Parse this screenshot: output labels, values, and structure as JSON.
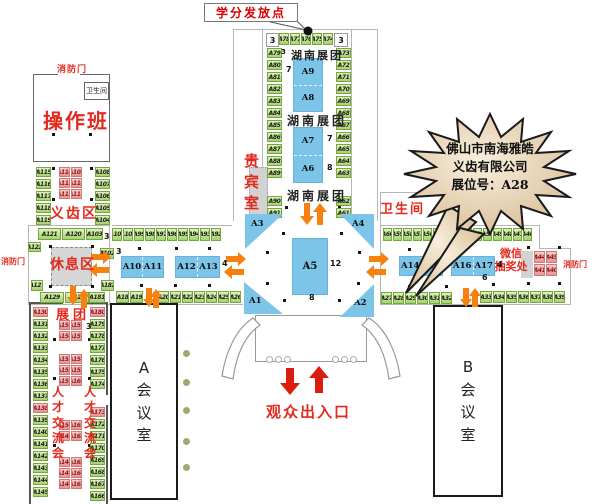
{
  "callout": {
    "label": "学分发放点"
  },
  "labels": {
    "fire_door": "消防门",
    "restroom_small": "卫生间",
    "operation_room": "操作班",
    "denture_zone": "义齿区",
    "vip_room": "贵\n宾\n室",
    "rest_area": "休息区",
    "hunan_pavilion": "湖南展团",
    "restroom_right": "卫生间",
    "wechat_lottery": "微信\n抽奖处",
    "exhibit_group": "展团",
    "talent_fair": "人\n才\n交\n流\n会",
    "hall_a": "A\n会\n议\n室",
    "hall_b": "B\n会\n议\n室",
    "entrance": "观众出入口"
  },
  "star": {
    "line1": "佛山市南海雅皓",
    "line2": "义齿有限公司",
    "line3": "展位号：A28"
  },
  "numbers": {
    "top_left": "3",
    "top_right": "3",
    "hunan_3": "3",
    "n7_a9": "7",
    "n7_a7": "7",
    "n8_a6": "8",
    "n12_a5": "12",
    "n8_a5": "8",
    "n4_a13": "4",
    "n4_a17": "4",
    "n6_a17": "6",
    "n3_a103": "3",
    "n3_a102": "3",
    "n3_talent": "3"
  },
  "blue": {
    "a1": "A1",
    "a2": "A2",
    "a3": "A3",
    "a4": "A4",
    "a5": "A5",
    "a6": "A6",
    "a7": "A7",
    "a8": "A8",
    "a9": "A9",
    "a10": "A10",
    "a11": "A11",
    "a12": "A12",
    "a13": "A13",
    "a14": "A14",
    "a15": "A15",
    "a16": "A16",
    "a17": "A17"
  },
  "booths": {
    "tower_top_row": [
      "A78",
      "A77",
      "A76",
      "A75",
      "A74"
    ],
    "tower_left_col": [
      "A79",
      "A80",
      "A81",
      "A82",
      "A83",
      "A84",
      "A85",
      "A86",
      "A87",
      "A88",
      "A89"
    ],
    "tower_left_lower": [
      "A90",
      "A91"
    ],
    "tower_right_col": [
      "A73",
      "A72",
      "A71",
      "A70",
      "A69",
      "A68",
      "A67",
      "A66",
      "A65",
      "A64",
      "A63"
    ],
    "tower_right_lower": [
      "A62",
      "A61"
    ],
    "dental_left": [
      "A115",
      "A116",
      "A117",
      "A118",
      "A119"
    ],
    "dental_pink": [
      "A114",
      "A109",
      "A113",
      "A110",
      "A112",
      "A111"
    ],
    "dental_right": [
      "A108",
      "A107",
      "A106",
      "A105",
      "A104"
    ],
    "mid_top_strip": [
      "A121",
      "A120"
    ],
    "a103": "A103",
    "a122": "A122",
    "a102": "A102",
    "a127": "A127",
    "a182": "A182",
    "a181": "A181",
    "mid_bottom_strip": [
      "A129",
      "A128"
    ],
    "mid_row": [
      "A101",
      "A100",
      "A99",
      "A98",
      "A97",
      "A96",
      "A95",
      "A94",
      "A93",
      "A92"
    ],
    "row18": [
      "A18",
      "A19"
    ],
    "row20": [
      "A20",
      "A21",
      "A22",
      "A23",
      "A24",
      "A25",
      "A26"
    ],
    "right_row": [
      "A60",
      "A59",
      "A58",
      "A57",
      "A56",
      "A55",
      "A54",
      "A53",
      "A52",
      "A51",
      "A50",
      "A49",
      "A48",
      "A47",
      "A46"
    ],
    "row27": [
      "A27",
      "A28",
      "A29",
      "A30",
      "A31",
      "A32"
    ],
    "row33": [
      "A33",
      "A34"
    ],
    "row35": [
      "A35",
      "A36",
      "A37",
      "A38",
      "A39"
    ],
    "lottery_pink": [
      "A44",
      "A45",
      "A41",
      "A40"
    ],
    "bottom_left_col": [
      {
        "t": "A130",
        "pink": true
      },
      {
        "t": "A131"
      },
      {
        "t": "A132"
      },
      {
        "t": "A133"
      },
      {
        "t": "A134"
      },
      {
        "t": "A135"
      },
      {
        "t": "A136"
      },
      {
        "t": "A137"
      },
      {
        "t": "A138",
        "pink": true
      },
      {
        "t": "A139"
      },
      {
        "t": "A140"
      },
      {
        "t": "A141"
      },
      {
        "t": "A142"
      },
      {
        "t": "A143"
      },
      {
        "t": "A144"
      },
      {
        "t": "A145"
      }
    ],
    "bottom_right_upper": [
      {
        "t": "A180",
        "pink": true
      },
      {
        "t": "A179"
      },
      {
        "t": "A178"
      },
      {
        "t": "A177"
      },
      {
        "t": "A176"
      },
      {
        "t": "A175"
      },
      {
        "t": "A174"
      }
    ],
    "bottom_right_lower": [
      {
        "t": "A173",
        "pink": true
      },
      {
        "t": "A172"
      },
      {
        "t": "A171"
      },
      {
        "t": "A170"
      },
      {
        "t": "A169"
      },
      {
        "t": "A168"
      },
      {
        "t": "A167"
      },
      {
        "t": "A166"
      }
    ],
    "talent1": [
      "A155",
      "A156",
      "A154",
      "A157"
    ],
    "talent2": [
      "A153",
      "A158",
      "A152",
      "A159",
      "A151",
      "A160"
    ],
    "talent3": [
      "A150",
      "A161",
      "A149",
      "A162"
    ],
    "talent4": [
      "A148",
      "A163",
      "A147",
      "A164",
      "A146",
      "A165"
    ]
  },
  "colors": {
    "booth_green": "#a7d26e",
    "booth_pink": "#eb9393",
    "stand_blue": "#7cc5e8",
    "arrow_orange": "#f8800f",
    "arrow_red": "#da1d0f",
    "accent_red": "#e32a1e",
    "star_fill": "#e9d6b8"
  }
}
